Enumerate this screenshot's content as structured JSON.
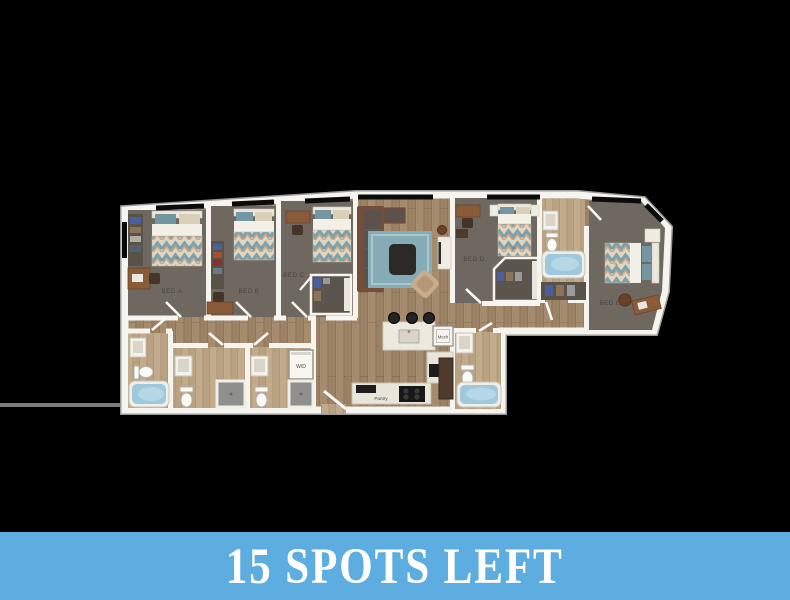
{
  "page": {
    "background_color": "#000000"
  },
  "banner": {
    "text": "15 SPOTS LEFT",
    "background_color": "#5dade0",
    "text_color": "#ffffff"
  },
  "floor_plan": {
    "rooms": {
      "bed_a": {
        "label": "BED A"
      },
      "bed_b": {
        "label": "BED B"
      },
      "bed_c": {
        "label": "BED C"
      },
      "bed_d": {
        "label": "BED D"
      },
      "bed_e": {
        "label": "BED E"
      }
    },
    "labels": {
      "washer_dryer": "W/D",
      "mechanical": "Mech",
      "pantry": "Pantry"
    },
    "bed_tag": "XL",
    "colors": {
      "wall": "#f6f4ef",
      "carpet": "#6e6860",
      "wood_floor": "#a68c6e",
      "bath_floor": "#c2ab8b",
      "tub": "#9fc8dd",
      "shower": "#8f8f8d",
      "rug": "#85abb6",
      "sofa": "#744e38",
      "window": "#0b0b0b",
      "label_text": "#4b453e"
    }
  }
}
